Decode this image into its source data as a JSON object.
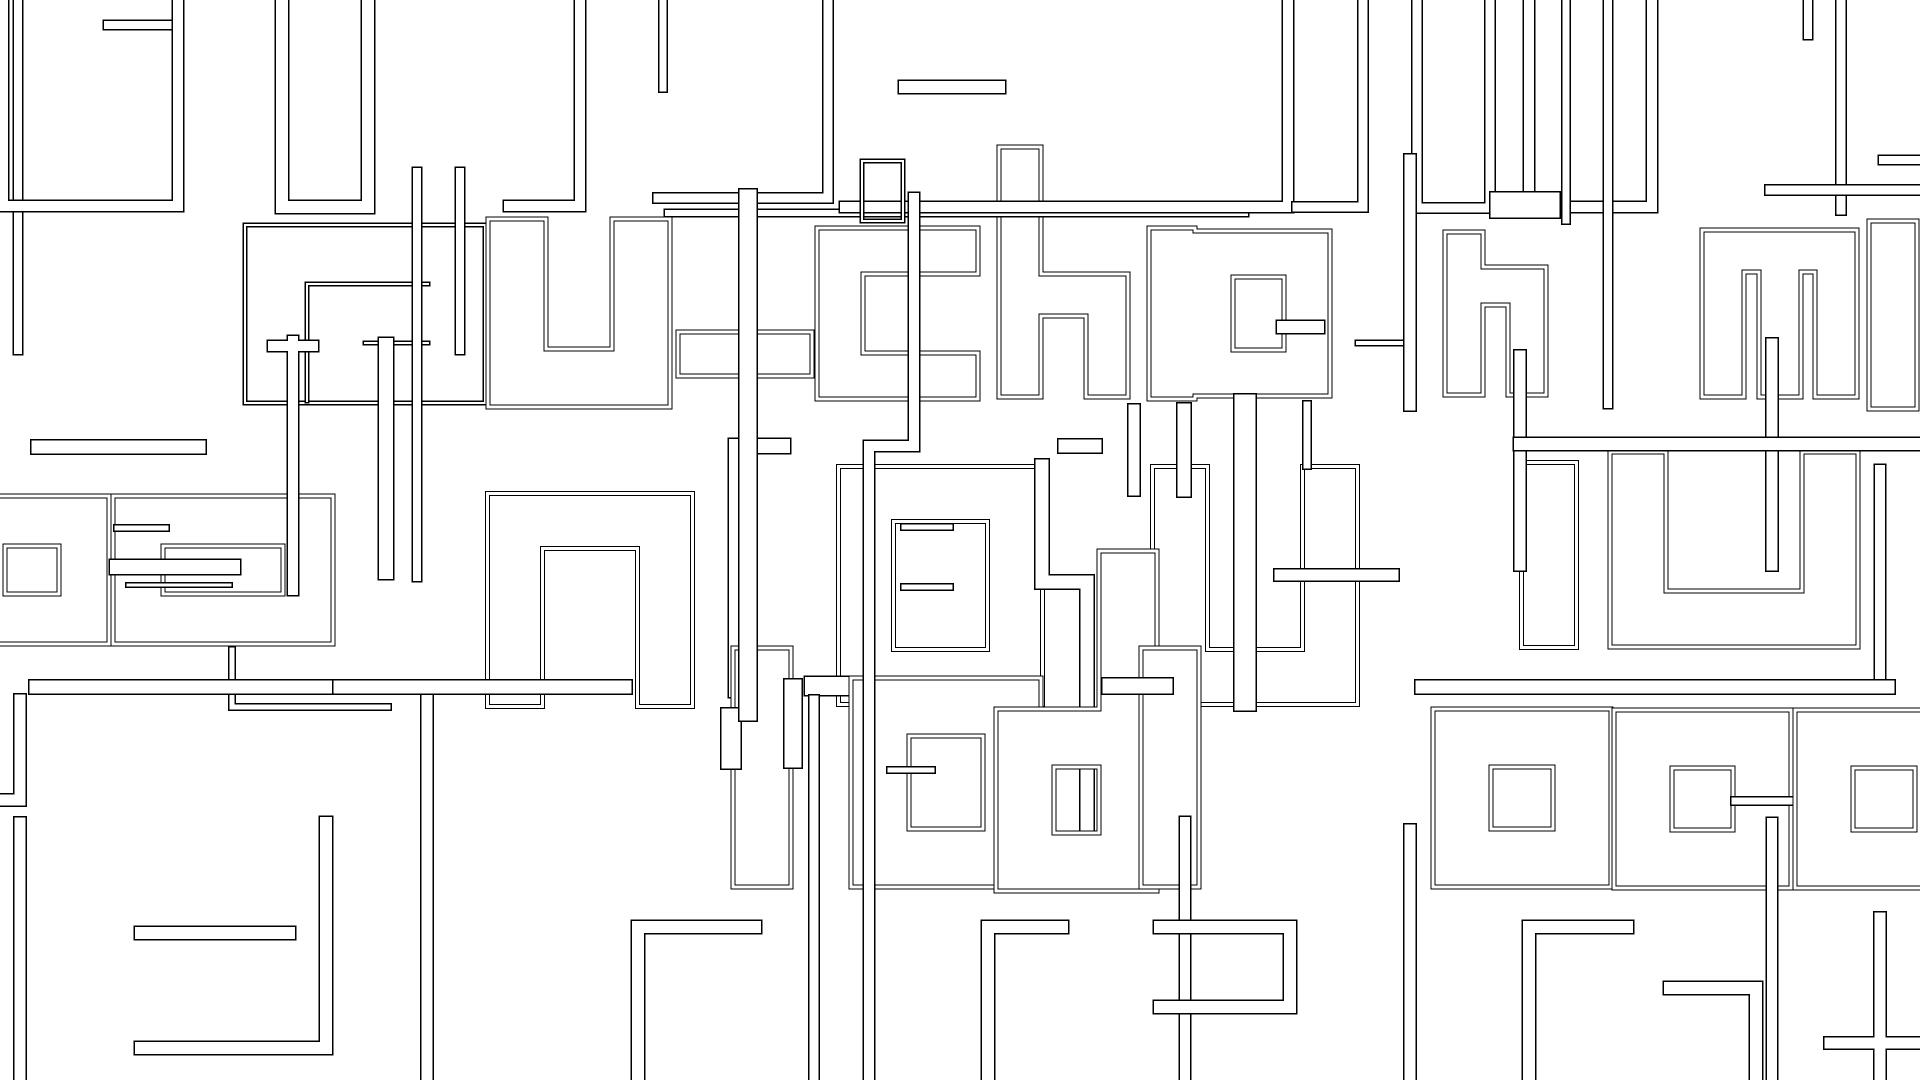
{
  "canvas": {
    "width": 1920,
    "height": 1080,
    "background_color": "#ffffff",
    "line_color": "#000000",
    "counter_color": "#ffffff"
  },
  "shapes": [
    {
      "name": "row2-letter-a-box",
      "d": "M245,225 H485 V403 H245 Z",
      "w": 5,
      "style": "band"
    },
    {
      "name": "row2-letter-a-hook",
      "d": "M428,284 H307 V401",
      "w": 5,
      "style": "band"
    },
    {
      "name": "row2-letter-a-dash",
      "d": "M365,343 H428",
      "w": 5,
      "style": "band"
    },
    {
      "name": "row2-letter-u",
      "d": "M517,248 V378 H641 V248",
      "w": 58,
      "style": "glyph"
    },
    {
      "name": "row2-letter-t-crossbar",
      "d": "M700,354 H790",
      "w": 44,
      "style": "glyph"
    },
    {
      "name": "row2-letter-c",
      "d": "M955,251 H840 V376 H955",
      "w": 46,
      "style": "glyph"
    },
    {
      "name": "row2-letter-h",
      "d": "M1020,168 V376 M1020,295 H1107 V376",
      "w": 42,
      "style": "glyph"
    },
    {
      "name": "row2-letter-p",
      "d": "M1172,251 V376 M1210,254 H1307 V373 H1210 Z",
      "w": 46,
      "style": "glyph"
    },
    {
      "name": "row2-p-stub",
      "d": "M1283,327 H1318",
      "w": 15,
      "style": "band"
    },
    {
      "name": "row2-dash-right",
      "d": "M1358,343 H1403",
      "w": 7,
      "style": "band"
    },
    {
      "name": "row2-letter-n",
      "d": "M1464,251 V376 M1464,286 H1527 V376",
      "w": 38,
      "style": "glyph"
    },
    {
      "name": "row2-letter-m",
      "d": "M1723,376 V251 H1836 V376 M1780,251 V376",
      "w": 42,
      "style": "glyph"
    },
    {
      "name": "row2-letter-t-right",
      "d": "M1893,245 V385",
      "w": 48,
      "style": "glyph"
    },
    {
      "name": "row3-letter-e-left",
      "d": "M-20,521 H84 V619 H-20 Z",
      "w": 50,
      "style": "glyph"
    },
    {
      "name": "row3-letter-g",
      "d": "M138,521 H308 V619 H138 Z",
      "w": 50,
      "style": "glyph"
    },
    {
      "name": "row3-letter-n",
      "d": "M515,679 V521 H665 V679",
      "w": 55,
      "style": "glyph"
    },
    {
      "name": "row3-letter-a",
      "d": "M866,494 H1015 V677 H866 Z",
      "w": 55,
      "style": "glyph"
    },
    {
      "name": "row3-letter-u",
      "d": "M1180,494 V677 H1330 V494",
      "w": 55,
      "style": "glyph"
    },
    {
      "name": "row3-letter-i-right",
      "d": "M1549,490 V620",
      "w": 55,
      "style": "glyph"
    },
    {
      "name": "row3-letter-e-right",
      "d": "M1638,480 V619 H1830 V480",
      "w": 56,
      "style": "glyph"
    },
    {
      "name": "row3-hook-thin",
      "d": "M783,446 H736 V690",
      "w": 17,
      "style": "band"
    },
    {
      "name": "row3-step-thin",
      "d": "M1042,466 V582 H1087 V840",
      "w": 16,
      "style": "band"
    },
    {
      "name": "row4-letter-f-stem",
      "d": "M762,677 V858",
      "w": 58,
      "style": "glyph"
    },
    {
      "name": "row4-f-tab-left",
      "d": "M731,718 V759",
      "w": 22,
      "style": "band"
    },
    {
      "name": "row4-f-tab-right",
      "d": "M793,688 V759",
      "w": 20,
      "style": "band"
    },
    {
      "name": "row4-f-hook",
      "d": "M814,686 H851",
      "w": 21,
      "style": "band"
    },
    {
      "name": "row4-letter-e",
      "d": "M880,707 H1012 V858 H880 Z",
      "w": 58,
      "style": "glyph"
    },
    {
      "name": "row4-e-dash",
      "d": "M890,770 H932",
      "w": 8,
      "style": "band"
    },
    {
      "name": "row4-letter-d",
      "d": "M1128,580 V862 H1025 V738 H1128",
      "w": 58,
      "style": "glyph"
    },
    {
      "name": "row4-letter-r",
      "d": "M1170,677 V858",
      "w": 58,
      "style": "glyph"
    },
    {
      "name": "row4-r-bar",
      "d": "M1110,686 H1165",
      "w": 18,
      "style": "band"
    },
    {
      "name": "row4-letter-e2",
      "d": "M1462,738 H1582 V858 H1462 Z",
      "w": 58,
      "style": "glyph"
    },
    {
      "name": "row4-letter-c",
      "d": "M1643,739 H1762 V859 H1643 Z",
      "w": 58,
      "style": "glyph"
    },
    {
      "name": "row4-c-stub",
      "d": "M1735,801 H1793",
      "w": 10,
      "style": "band"
    },
    {
      "name": "row4-letter-o-right",
      "d": "M1824,739 H1944 V859 H1824 Z",
      "w": 58,
      "style": "glyph"
    },
    {
      "name": "row1-bar-left",
      "d": "M18,-10 V350",
      "w": 11,
      "style": "band"
    },
    {
      "name": "row1-hook-stub",
      "d": "M108,25 H178",
      "w": 11,
      "style": "band"
    },
    {
      "name": "row1-box-left",
      "d": "M3,-20 V206 H178 V-20",
      "w": 13,
      "style": "band"
    },
    {
      "name": "row1-box-2",
      "d": "M282,-20 V207 H368 V-20",
      "w": 15,
      "style": "band"
    },
    {
      "name": "row1-foot-3",
      "d": "M580,-12 V206 H509",
      "w": 13,
      "style": "band"
    },
    {
      "name": "row1-bar-mid",
      "d": "M663,-12 V88",
      "w": 10,
      "style": "band"
    },
    {
      "name": "row1-box-4",
      "d": "M828,-12 V198 H658",
      "w": 12,
      "style": "band"
    },
    {
      "name": "row1-ledge",
      "d": "M668,213 H1245",
      "w": 9,
      "style": "band"
    },
    {
      "name": "row1-box-5",
      "d": "M845,207 H1288 V-12",
      "w": 13,
      "style": "band"
    },
    {
      "name": "row1-dash-top",
      "d": "M905,87 H999",
      "w": 15,
      "style": "band"
    },
    {
      "name": "row1-small-square",
      "d": "M862,161 H903 V221 H862 Z",
      "w": 5,
      "style": "band"
    },
    {
      "name": "row1-box-6",
      "d": "M1297,207 H1363 V-12",
      "w": 12,
      "style": "band"
    },
    {
      "name": "row1-box-7",
      "d": "M1417,-12 V208 H1490 V-12",
      "w": 12,
      "style": "band"
    },
    {
      "name": "row1-box-8",
      "d": "M1529,-12 V207 H1652 V-12",
      "w": 13,
      "style": "band"
    },
    {
      "name": "row1-bar-8b",
      "d": "M1566,-12 V220",
      "w": 10,
      "style": "band"
    },
    {
      "name": "row1-bar-right",
      "d": "M1841,-12 V210",
      "w": 12,
      "style": "band"
    },
    {
      "name": "row1-stub-right",
      "d": "M1808,-12 V35",
      "w": 11,
      "style": "band"
    },
    {
      "name": "row1-ledge-right",
      "d": "M1770,190 H1930",
      "w": 12,
      "style": "band"
    },
    {
      "name": "row1-dash-right",
      "d": "M1883,160 H1930",
      "w": 11,
      "style": "band"
    },
    {
      "name": "row2-top-notch",
      "d": "M1503,205 H1547",
      "w": 28,
      "style": "band"
    },
    {
      "name": "vbar-t-cap",
      "d": "M273,346 H313 M293,341 V590",
      "w": 13,
      "style": "band"
    },
    {
      "name": "vbar-a-tail",
      "d": "M386,345 V572",
      "w": 17,
      "style": "band"
    },
    {
      "name": "vbar-bottom-1",
      "d": "M427,700 V1090",
      "w": 14,
      "style": "band"
    },
    {
      "name": "vbar-t-stem",
      "d": "M748,198 V712",
      "w": 20,
      "style": "band"
    },
    {
      "name": "vbar-jog-long",
      "d": "M914,198 V446 H869 V1085",
      "w": 13,
      "style": "band"
    },
    {
      "name": "vbar-bottom-2",
      "d": "M814,700 V1090",
      "w": 12,
      "style": "band"
    },
    {
      "name": "vbar-p-descender",
      "d": "M1245,405 V700",
      "w": 24,
      "style": "band"
    },
    {
      "name": "vbar-p-descender-2",
      "d": "M1307,405 V465",
      "w": 10,
      "style": "band"
    },
    {
      "name": "vbar-h-ascender",
      "d": "M1410,160 V405",
      "w": 14,
      "style": "band"
    },
    {
      "name": "vbar-bottom-3",
      "d": "M1410,830 V1085",
      "w": 14,
      "style": "band"
    },
    {
      "name": "vbar-right-1",
      "d": "M1772,344 V565",
      "w": 14,
      "style": "band"
    },
    {
      "name": "vbar-bottom-4",
      "d": "M1772,823 V1085",
      "w": 13,
      "style": "band"
    },
    {
      "name": "vbar-right-2",
      "d": "M1520,356 V565",
      "w": 14,
      "style": "band"
    },
    {
      "name": "vbar-bottom-5",
      "d": "M1185,822 V1085",
      "w": 13,
      "style": "band"
    },
    {
      "name": "vbar-right-3",
      "d": "M1880,470 V685",
      "w": 13,
      "style": "band"
    },
    {
      "name": "vbar-tall-left-1",
      "d": "M417,172 V577",
      "w": 11,
      "style": "band"
    },
    {
      "name": "vbar-tall-left-2",
      "d": "M460,172 V350",
      "w": 11,
      "style": "band"
    },
    {
      "name": "row3-bar-above",
      "d": "M38,447 H199",
      "w": 16,
      "style": "band"
    },
    {
      "name": "row3-dash-1",
      "d": "M117,528 H166",
      "w": 8,
      "style": "band"
    },
    {
      "name": "row3-mid-bar",
      "d": "M117,567 H233",
      "w": 17,
      "style": "band"
    },
    {
      "name": "row3-mid-line",
      "d": "M128,585 H230",
      "w": 6,
      "style": "band"
    },
    {
      "name": "row3-connector",
      "d": "M232,650 V707 H388",
      "w": 8,
      "style": "band"
    },
    {
      "name": "row3-long-bar-1",
      "d": "M36,687 H331",
      "w": 16,
      "style": "band"
    },
    {
      "name": "row3-long-bar-2",
      "d": "M340,687 H625",
      "w": 16,
      "style": "band"
    },
    {
      "name": "row3-a-dash-1",
      "d": "M904,527 H950",
      "w": 8,
      "style": "band"
    },
    {
      "name": "row3-a-dash-2",
      "d": "M904,587 H950",
      "w": 8,
      "style": "band"
    },
    {
      "name": "row3-stub-1",
      "d": "M1134,410 V490",
      "w": 14,
      "style": "band"
    },
    {
      "name": "row3-stub-2",
      "d": "M1184,410 V490",
      "w": 16,
      "style": "band"
    },
    {
      "name": "row3-top-bar-right",
      "d": "M1520,444 H1930",
      "w": 15,
      "style": "band"
    },
    {
      "name": "row3-dash-right",
      "d": "M1280,575 H1393",
      "w": 14,
      "style": "band"
    },
    {
      "name": "row3-long-bar-right",
      "d": "M1422,687 H1888",
      "w": 16,
      "style": "band"
    },
    {
      "name": "row2-below-square",
      "d": "M1065,446 H1095",
      "w": 16,
      "style": "band"
    },
    {
      "name": "vbar-row2-right",
      "d": "M1608,-10 V404",
      "w": 11,
      "style": "band"
    },
    {
      "name": "row5-bar-1",
      "d": "M141,933 H289",
      "w": 15,
      "style": "band"
    },
    {
      "name": "row5-hook-1",
      "d": "M326,823 V1048 H141",
      "w": 15,
      "style": "band"
    },
    {
      "name": "row5-hook-2",
      "d": "M755,927 H638 V1085",
      "w": 15,
      "style": "band"
    },
    {
      "name": "row5-hook-3",
      "d": "M1062,927 H988 V1085",
      "w": 15,
      "style": "band"
    },
    {
      "name": "row5-bracket",
      "d": "M1160,927 H1290 V1007 H1160",
      "w": 15,
      "style": "band"
    },
    {
      "name": "row5-hook-4",
      "d": "M1627,927 H1529 V1085",
      "w": 15,
      "style": "band"
    },
    {
      "name": "row5-hook-5",
      "d": "M1670,988 H1756 V1085",
      "w": 15,
      "style": "band"
    },
    {
      "name": "row5-right-pieces",
      "d": "M1830,1043 H1930 M1880,918 V1085",
      "w": 14,
      "style": "band"
    },
    {
      "name": "row5-left-pieces",
      "d": "M20,700 V800 H-15 M20,823 V1085",
      "w": 14,
      "style": "band"
    }
  ]
}
